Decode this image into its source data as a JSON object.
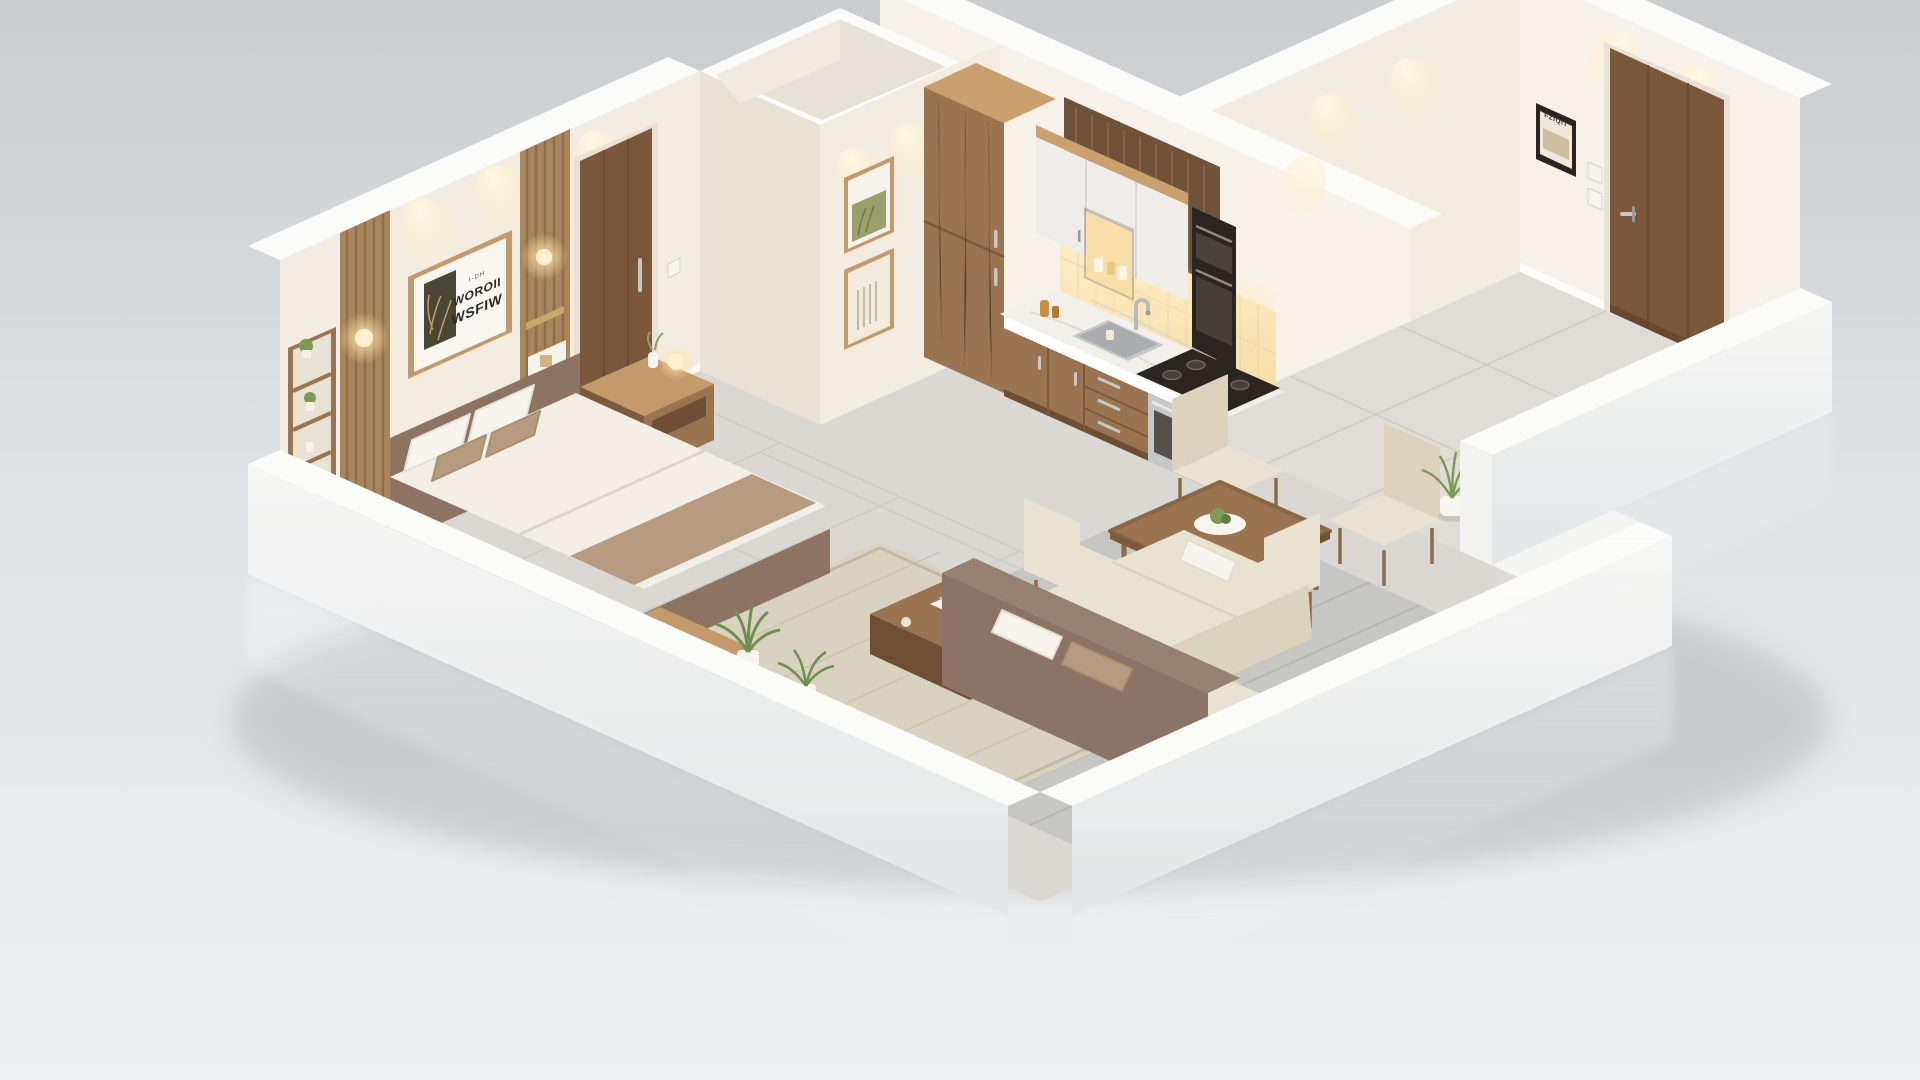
{
  "scene": {
    "title": "isometric-apartment-render",
    "description": "3D isometric cutaway render of a one-bedroom apartment with bedroom, hallway, kitchen, dining and living areas",
    "art_print": {
      "line1": "I-DH",
      "line2": "WOROII",
      "line3": "WSFIW"
    },
    "entry_frame_text": "FZIQIT",
    "palette": {
      "bgTop": "#c9cdd0",
      "bgMid": "#dfe2e4",
      "bgBot": "#eef0f1",
      "wallCream": "#f2ece1",
      "wallLight": "#f7f2e9",
      "wallShade": "#e9e1d3",
      "capWhite": "#fbfbfa",
      "wallOuter": "#f3f3f2",
      "outerShadow": "#d9dcde",
      "floorTile": "#dad8d3",
      "floorWarm": "#e0ddd6",
      "plank": "#c6c7c5",
      "grout": "#b4b6b4",
      "rug": "#d9d2c1",
      "rugBorder": "#c3b9a3",
      "woodMid": "#9a7450",
      "woodDark": "#7c5a3c",
      "woodLight": "#c49a6c",
      "woodTop": "#caa06e",
      "slat": "#a8855c",
      "slatDark": "#6e523a",
      "doorWood": "#7a563a",
      "doorDark": "#66462c",
      "bedFrame": "#8d7462",
      "bedFrameDark": "#7b6250",
      "bedding": "#f3efe6",
      "taupe": "#b59b80",
      "pillow": "#f7f4ed",
      "sofaBase": "#8b7466",
      "cushion": "#eae2d1",
      "cushionShade": "#dcd2bd",
      "counter": "#f3f0e9",
      "steel": "#c6c8c8",
      "steelDark": "#9a9d9e",
      "black": "#2a2521",
      "glow": "#ffe3ae",
      "glowSoft": "#fff3d9",
      "green": "#7d9b55",
      "greenDark": "#5f7b41",
      "yellow": "#e8cb62",
      "shadow": "#aeb2b6",
      "artOlive": "#4a4636"
    },
    "rooms": [
      {
        "name": "bedroom",
        "items": [
          "slat-accent-panels",
          "wall-sconces",
          "wall-shelf-unit",
          "framed-art-print",
          "double-bed",
          "pillows",
          "throw-runner",
          "nightstand",
          "media-stand",
          "potted-palms",
          "area-rug",
          "coffee-table",
          "interior-door"
        ]
      },
      {
        "name": "hallway",
        "items": [
          "framed-poster-botanical",
          "framed-poster-lines",
          "bathroom-volume",
          "light-switch"
        ]
      },
      {
        "name": "kitchen",
        "items": [
          "tall-pantry-cabinet",
          "wood-slat-feature",
          "upper-cabinets",
          "lit-open-niche",
          "built-in-oven-column",
          "tile-backsplash",
          "marble-counter",
          "sink-with-faucet",
          "gas-range",
          "base-cabinets"
        ]
      },
      {
        "name": "dining",
        "items": [
          "square-dining-table",
          "centerpiece-plate",
          "four-upholstered-chairs"
        ]
      },
      {
        "name": "living",
        "items": [
          "l-shaped-sectional-sofa",
          "back-console",
          "floor-plant"
        ]
      },
      {
        "name": "entry",
        "items": [
          "entry-door",
          "small-framed-photo",
          "light-switches",
          "potted-plant"
        ]
      }
    ]
  }
}
